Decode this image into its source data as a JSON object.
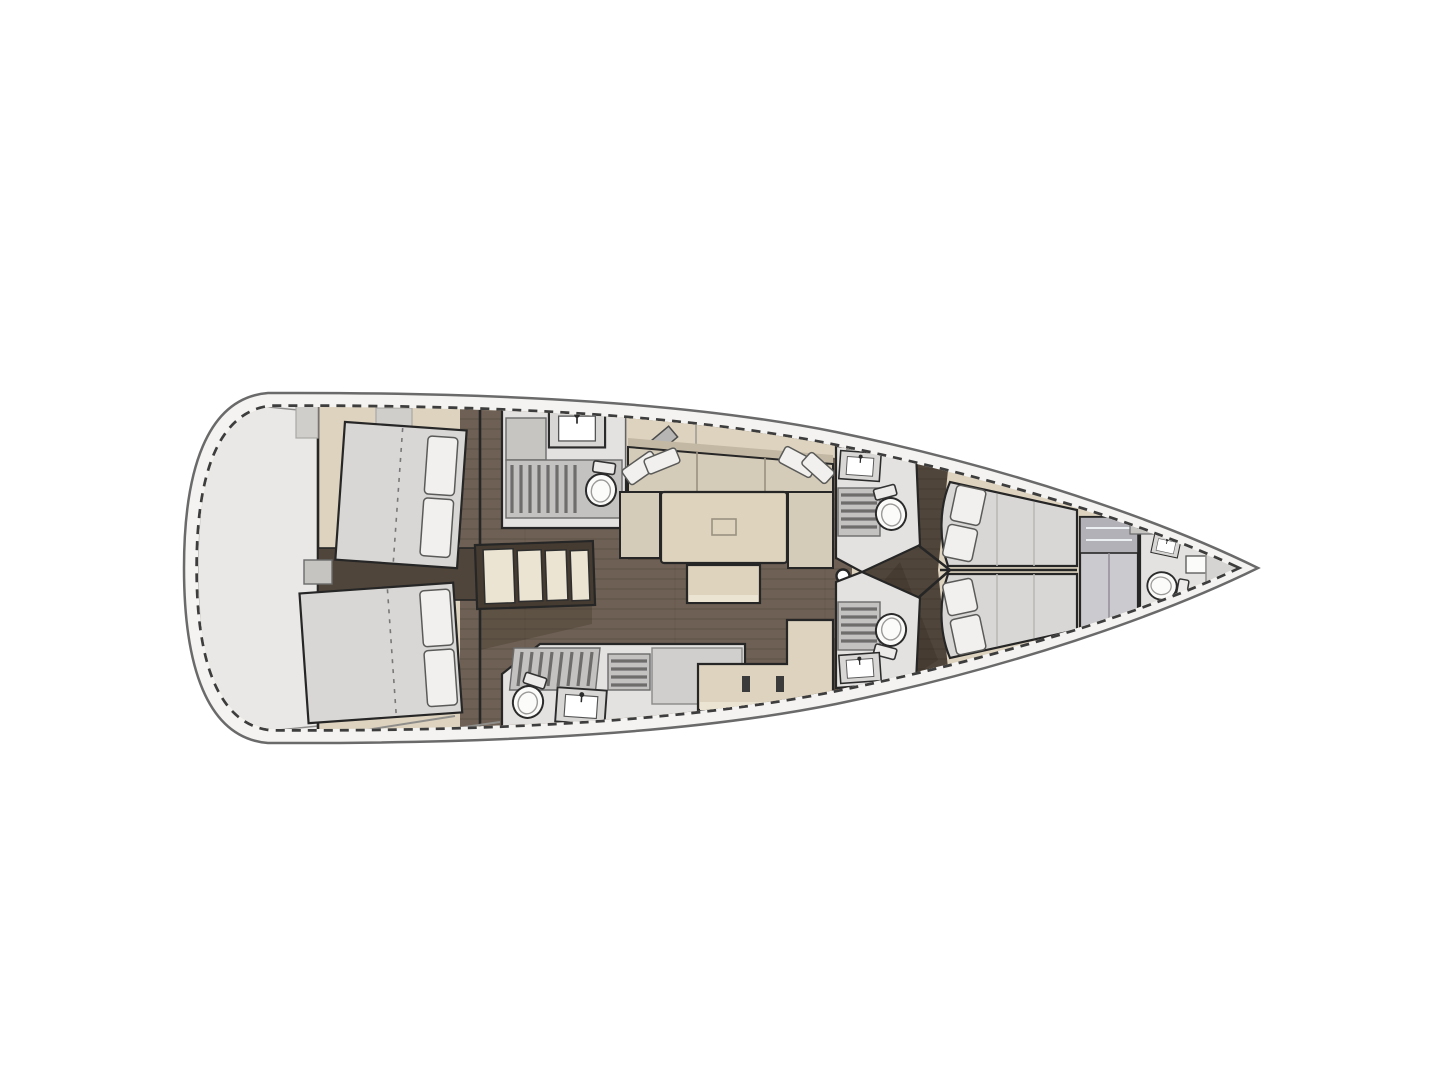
{
  "diagram": {
    "type": "yacht-interior-floor-plan",
    "orientation": "bow-right",
    "rooms": [
      {
        "id": "swim-platform",
        "label": "stern swim platform"
      },
      {
        "id": "aft-cabin-port",
        "label": "aft double cabin (port)",
        "berths": 1
      },
      {
        "id": "aft-cabin-starboard",
        "label": "aft double cabin (starboard)",
        "berths": 1
      },
      {
        "id": "head-aft-port",
        "label": "aft head with shower (port)"
      },
      {
        "id": "head-aft-starboard",
        "label": "aft head with shower (starboard)"
      },
      {
        "id": "companionway",
        "label": "companionway stairs",
        "treads": 4
      },
      {
        "id": "salon",
        "label": "salon with U-sofa, table and bench"
      },
      {
        "id": "head-fwd-port",
        "label": "forward head with shower (port)"
      },
      {
        "id": "head-fwd-starboard",
        "label": "forward head with shower (starboard)"
      },
      {
        "id": "fwd-cabin-port",
        "label": "forward double cabin (port)",
        "berths": 1
      },
      {
        "id": "fwd-cabin-starboard",
        "label": "forward double cabin (starboard)",
        "berths": 1
      },
      {
        "id": "wardrobe",
        "label": "wardrobe / hanging locker"
      },
      {
        "id": "head-bow",
        "label": "bow crew head"
      },
      {
        "id": "bow-locker",
        "label": "bow anchor locker"
      }
    ],
    "fixtures": {
      "toilets": 5,
      "sinks": 5,
      "shower_grates": 4,
      "double_berths": 4,
      "tables": 1,
      "sofas": 1,
      "mast_post": 1
    }
  },
  "colors": {
    "hullLine": "#6a6a6a",
    "toeRail": "#3d3d3d",
    "deckWhite": "#f4f3f1",
    "transom": "#e9e8e6",
    "cream": "#ddd3bf",
    "creamLight": "#ebe4d2",
    "wood": "#6e6054",
    "woodDark": "#50453b",
    "mattress": "#d8d7d5",
    "pillow": "#f1f0ee",
    "sofa": "#d5cbb9",
    "sofaShade": "#c3b8a4",
    "tableTop": "#ded3bd",
    "headFloor": "#e3e2e0",
    "grateBg": "#c3c2c0",
    "grateBar": "#6e6d6c",
    "fixture": "#fbfbfa",
    "wardrobe": "#cbcacf",
    "wardrobeDark": "#b2b1b7",
    "wall": "#262626",
    "shadow": "rgba(40,30,18,0.22)"
  }
}
